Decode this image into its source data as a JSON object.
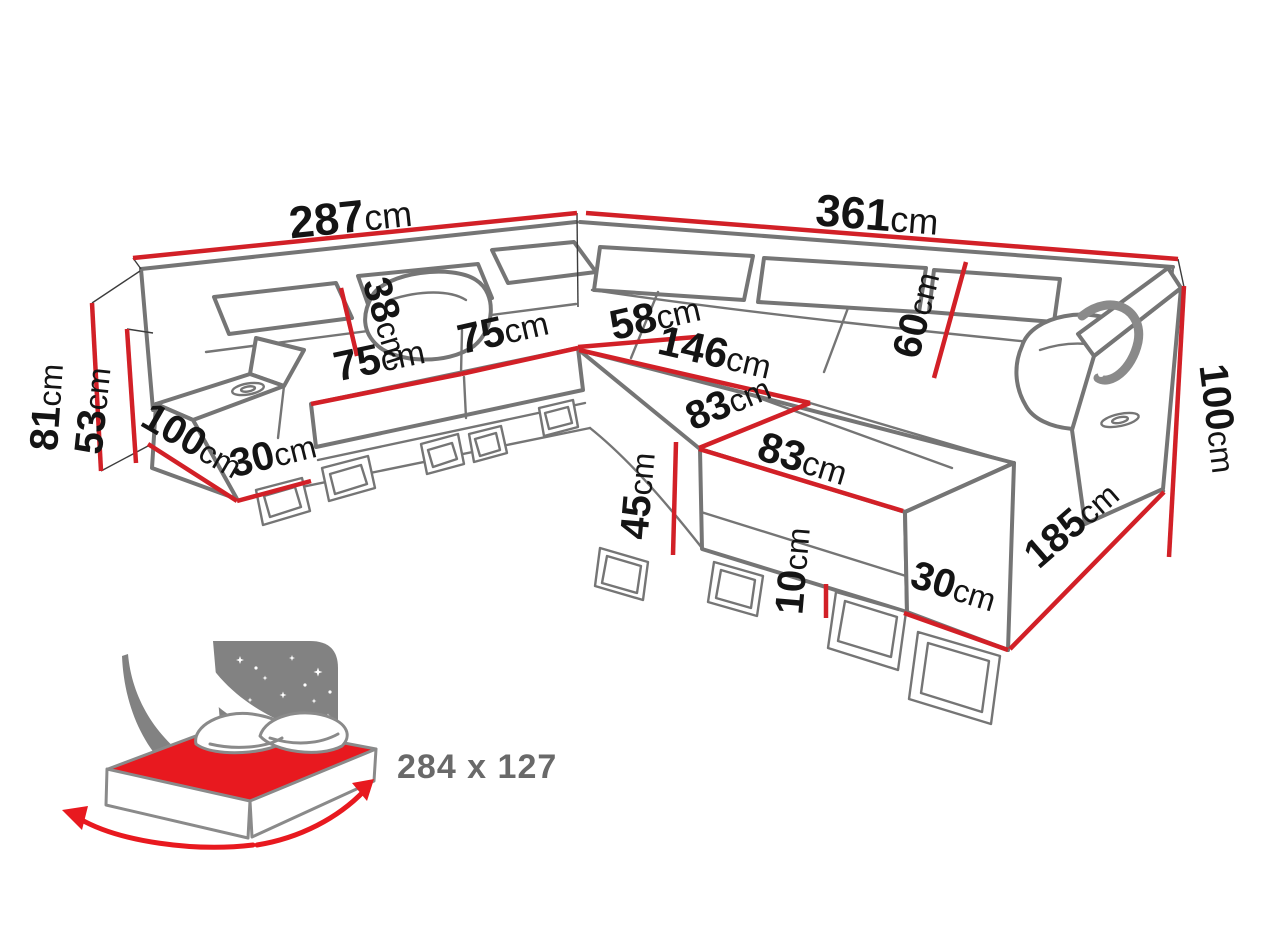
{
  "meta": {
    "type": "corner-sofa-dimension-diagram"
  },
  "colors": {
    "dimension_red": "#d22027",
    "sofa_outline_gray": "#757575",
    "label_ink": "#141414",
    "bed_icon_gray": "#828282",
    "bed_mattress_red": "#e8191f",
    "bed_size_text_gray": "#696969"
  },
  "dimensions": [
    {
      "name": "back-width-left",
      "value": "287",
      "unit": "cm"
    },
    {
      "name": "back-width-right",
      "value": "361",
      "unit": "cm"
    },
    {
      "name": "total-height",
      "value": "81",
      "unit": "cm"
    },
    {
      "name": "backrest-height-left",
      "value": "53",
      "unit": "cm"
    },
    {
      "name": "depth-left",
      "value": "100",
      "unit": "cm"
    },
    {
      "name": "armrest-width-left",
      "value": "30",
      "unit": "cm"
    },
    {
      "name": "seat-width-1",
      "value": "75",
      "unit": "cm"
    },
    {
      "name": "headrest-height",
      "value": "38",
      "unit": "cm"
    },
    {
      "name": "seat-width-2",
      "value": "75",
      "unit": "cm"
    },
    {
      "name": "corner-seat-width",
      "value": "58",
      "unit": "cm"
    },
    {
      "name": "chaise-length",
      "value": "146",
      "unit": "cm"
    },
    {
      "name": "chaise-width-back",
      "value": "83",
      "unit": "cm"
    },
    {
      "name": "chaise-width-front",
      "value": "83",
      "unit": "cm"
    },
    {
      "name": "backrest-height-right",
      "value": "60",
      "unit": "cm"
    },
    {
      "name": "height-right",
      "value": "100",
      "unit": "cm"
    },
    {
      "name": "chaise-front-height",
      "value": "45",
      "unit": "cm"
    },
    {
      "name": "leg-height",
      "value": "10",
      "unit": "cm"
    },
    {
      "name": "base-width-right",
      "value": "30",
      "unit": "cm"
    },
    {
      "name": "depth-right",
      "value": "185",
      "unit": "cm"
    }
  ],
  "bed": {
    "sleeping_size": "284 x 127"
  }
}
